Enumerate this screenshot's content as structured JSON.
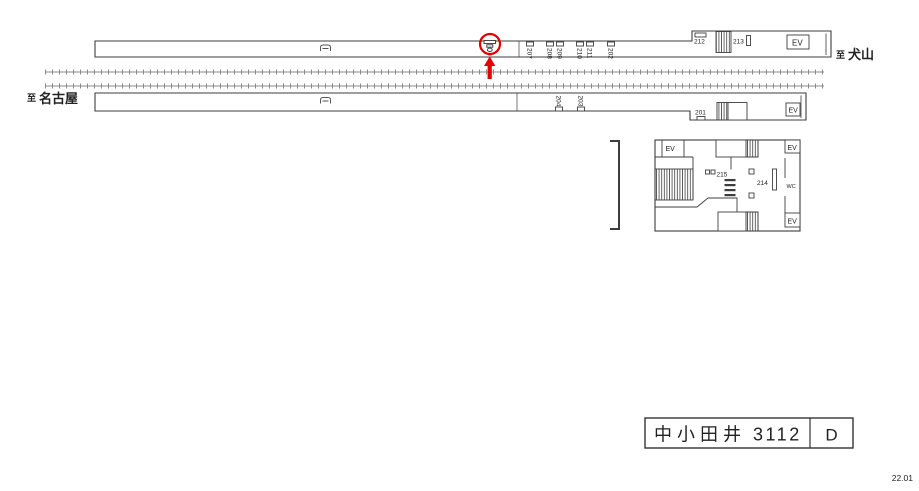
{
  "revision": "22.01",
  "sign_box": {
    "station": "中小田井",
    "code": "3112",
    "letter": "D"
  },
  "directions": {
    "to_prefix": "至",
    "right": "犬山",
    "left": "名古屋"
  },
  "labels": {
    "ev": "EV",
    "wc": "WC"
  },
  "platform_top": {
    "ads_rotated": [
      "207",
      "208",
      "209",
      "210",
      "211",
      "202"
    ],
    "ad_212": "212",
    "ad_213": "213"
  },
  "platform_bottom": {
    "ads_rotated": [
      "204",
      "203"
    ],
    "ad_201": "201"
  },
  "concourse": {
    "ad_215": "215",
    "ad_214": "214"
  },
  "colors": {
    "accent_red": "#e60000",
    "line": "#3d3d3d",
    "track": "#8a8a8a"
  }
}
